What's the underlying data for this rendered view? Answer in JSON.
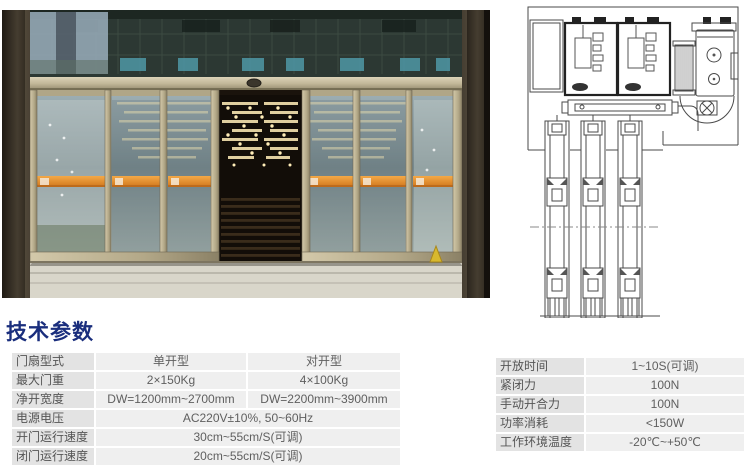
{
  "section_title": "技术参数",
  "photo": {
    "name": "automatic-sliding-glass-door-entrance-photo",
    "warning_strip_color": "#e08a2e",
    "frame_color": "#b3a888",
    "transom_glass_color": "#2c3833"
  },
  "diagram": {
    "name": "sliding-door-mechanism-cross-section-diagram",
    "line_color": "#4a4a4a"
  },
  "colors": {
    "title_blue": "#1a2e7d",
    "label_cell_bg": "#e3e3e3",
    "value_cell_bg": "#efefef",
    "table_text": "#5f5f5f"
  },
  "left_table": {
    "rows": [
      {
        "label": "门扇型式",
        "values": [
          "单开型",
          "对开型"
        ]
      },
      {
        "label": "最大门重",
        "values": [
          "2×150Kg",
          "4×100Kg"
        ]
      },
      {
        "label": "净开宽度",
        "values": [
          "DW=1200mm~2700mm",
          "DW=2200mm~3900mm"
        ]
      },
      {
        "label": "电源电压",
        "values": [
          "AC220V±10%, 50~60Hz"
        ]
      },
      {
        "label": "开门运行速度",
        "values": [
          "30cm~55cm/S(可调)"
        ]
      },
      {
        "label": "闭门运行速度",
        "values": [
          "20cm~55cm/S(可调)"
        ]
      }
    ]
  },
  "right_table": {
    "rows": [
      {
        "label": "开放时间",
        "value": "1~10S(可调)"
      },
      {
        "label": "紧闭力",
        "value": "100N"
      },
      {
        "label": "手动开合力",
        "value": "100N"
      },
      {
        "label": "功率消耗",
        "value": "<150W"
      },
      {
        "label": "工作环境温度",
        "value": "-20℃~+50℃"
      }
    ]
  }
}
